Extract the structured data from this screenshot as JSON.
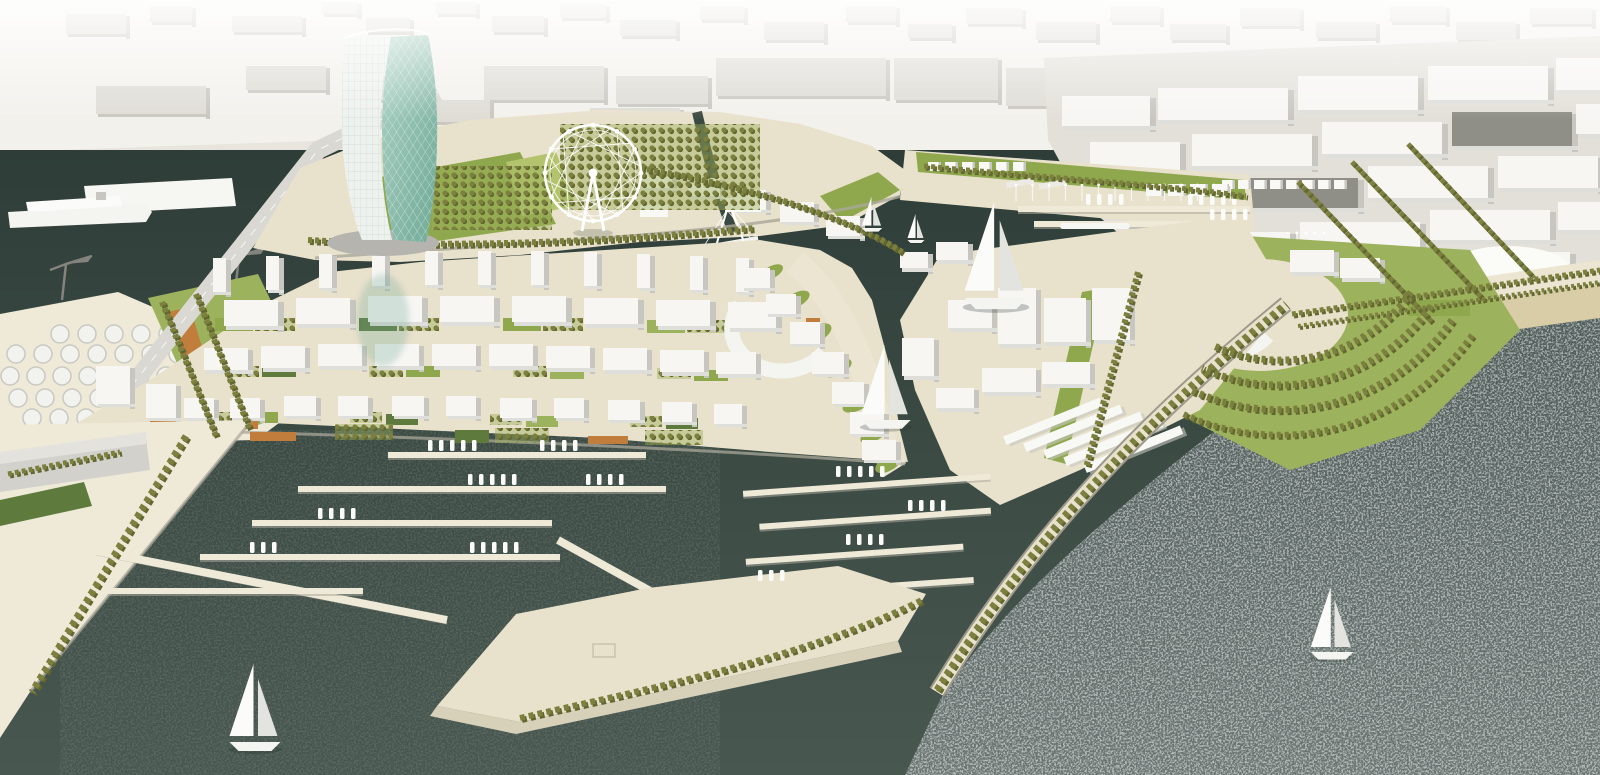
{
  "scene": {
    "description": "Aerial architectural rendering of a waterfront marina masterplan with twisted glass tower, ferris wheel, marinas, breakwaters, beach and background city massing",
    "objects": [
      "twisted-glass-tower",
      "ferris-wheel",
      "central-building-district",
      "left-marina",
      "middle-marina",
      "inner-basin",
      "east-breakwater",
      "beach",
      "open-sea",
      "port-tanks",
      "harbor-cranes",
      "cruise-ship",
      "road-bridge",
      "crescent-park",
      "sailboats"
    ]
  },
  "colors": {
    "bg": "#f3f1ec",
    "bg_block": "#dedcd5",
    "bg_block_side": "#c9c7c0",
    "coast": "#e7e5de",
    "pier_gray": "#dbd9d2",
    "water_top": "#2e3d38",
    "water_mid": "#3c4b44",
    "water_low": "#485750",
    "sea_top": "#4e5c59",
    "sea_low": "#6a7572",
    "land": "#e8e1cc",
    "paving": "#efe9d8",
    "sand": "#d9cda8",
    "prom": "#ece5d2",
    "city_ground": "#e2e0d8",
    "lawn": "#8fa84e",
    "lawn_light": "#b4c36e",
    "lawn_mid": "#9db25c",
    "green_dark": "#5e7a3d",
    "olive": "#7c803f",
    "olive_dark": "#62662f",
    "orange": "#c07d3b",
    "bldg_top": "#f7f6f3",
    "bldg_side": "#c7c6c0",
    "bldg_front": "#dededa",
    "bldg_dark": "#8f8f88",
    "road": "#d9d8d2",
    "quay_wall": "#a9a79a",
    "shadow": "#1f2a26",
    "glass1": "#aed3c6",
    "glass2": "#6fa996",
    "tower_white": "#eef2ee",
    "crane": "#84837d",
    "hull": "#f4f4f1",
    "sail": "#fbfbf9",
    "sail_shade": "#e3e3df",
    "tank": "#f2f2ef",
    "tank_edge": "#c9c8c2"
  },
  "blocks": {
    "bg-blocks": {
      "top": "bg_block",
      "side": "bg_block_side",
      "front": "bg_block_side",
      "sw": 4,
      "fh": 3,
      "items": [
        [
          66,
          14,
          60,
          20
        ],
        [
          150,
          6,
          42,
          16
        ],
        [
          232,
          16,
          70,
          16
        ],
        [
          322,
          2,
          36,
          12
        ],
        [
          366,
          18,
          44,
          14
        ],
        [
          436,
          2,
          40,
          12
        ],
        [
          492,
          16,
          52,
          16
        ],
        [
          560,
          4,
          46,
          14
        ],
        [
          620,
          20,
          56,
          16
        ],
        [
          700,
          6,
          44,
          14
        ],
        [
          764,
          22,
          60,
          18
        ],
        [
          846,
          6,
          50,
          16
        ],
        [
          908,
          24,
          44,
          14
        ],
        [
          966,
          8,
          56,
          16
        ],
        [
          1036,
          22,
          60,
          18
        ],
        [
          1110,
          6,
          50,
          16
        ],
        [
          1170,
          24,
          56,
          16
        ],
        [
          1240,
          8,
          60,
          18
        ],
        [
          1316,
          22,
          60,
          16
        ],
        [
          1390,
          6,
          56,
          16
        ],
        [
          1456,
          22,
          60,
          18
        ],
        [
          1530,
          8,
          62,
          16
        ],
        [
          484,
          66,
          120,
          34
        ],
        [
          616,
          76,
          92,
          28
        ],
        [
          716,
          58,
          170,
          38
        ],
        [
          894,
          58,
          104,
          42
        ],
        [
          1006,
          68,
          88,
          38
        ],
        [
          246,
          66,
          80,
          24
        ],
        [
          96,
          86,
          110,
          28
        ],
        [
          352,
          76,
          70,
          24
        ],
        [
          1106,
          60,
          80,
          30
        ],
        [
          590,
          108,
          90,
          26
        ],
        [
          430,
          100,
          60,
          22
        ]
      ]
    },
    "right-city-blocks": {
      "top": "bldg_top",
      "side": "bldg_side",
      "front": "bldg_front",
      "sw": 6,
      "fh": 4,
      "items": [
        [
          1062,
          96,
          88,
          30
        ],
        [
          1158,
          88,
          130,
          32
        ],
        [
          1298,
          76,
          120,
          34
        ],
        [
          1428,
          66,
          120,
          34
        ],
        [
          1556,
          58,
          44,
          32
        ],
        [
          1090,
          142,
          90,
          30
        ],
        [
          1192,
          134,
          120,
          32
        ],
        [
          1322,
          122,
          120,
          32
        ],
        [
          1452,
          112,
          120,
          34,
          "bldg_dark"
        ],
        [
          1576,
          104,
          24,
          30
        ],
        [
          1128,
          188,
          100,
          28
        ],
        [
          1238,
          178,
          120,
          30,
          "bldg_dark"
        ],
        [
          1368,
          166,
          120,
          32
        ],
        [
          1498,
          156,
          100,
          32
        ],
        [
          1180,
          232,
          110,
          26
        ],
        [
          1300,
          222,
          120,
          28
        ],
        [
          1430,
          210,
          120,
          30
        ],
        [
          1558,
          202,
          42,
          28
        ],
        [
          1250,
          272,
          100,
          24
        ],
        [
          1360,
          262,
          110,
          26,
          "bldg_dark"
        ],
        [
          1480,
          252,
          90,
          26
        ],
        [
          1310,
          300,
          130,
          22
        ],
        [
          1452,
          290,
          130,
          22
        ]
      ]
    },
    "district-fins": {
      "top": "bldg_top",
      "side": "bldg_side",
      "front": "bldg_front",
      "sw": 5,
      "fh": 3,
      "w": 13,
      "h": 34,
      "items": [
        [
          213,
          258
        ],
        [
          266,
          256
        ],
        [
          319,
          254
        ],
        [
          372,
          252
        ],
        [
          425,
          251
        ],
        [
          478,
          251
        ],
        [
          531,
          251
        ],
        [
          584,
          252
        ],
        [
          637,
          254
        ],
        [
          690,
          256
        ],
        [
          736,
          258
        ]
      ]
    },
    "district-row1": {
      "top": "bldg_top",
      "side": "bldg_side",
      "front": "bldg_front",
      "sw": 6,
      "fh": 4,
      "items": [
        [
          224,
          300,
          54,
          26
        ],
        [
          296,
          298,
          54,
          26
        ],
        [
          368,
          296,
          54,
          26
        ],
        [
          440,
          296,
          54,
          26
        ],
        [
          512,
          296,
          54,
          26
        ],
        [
          584,
          298,
          54,
          26
        ],
        [
          656,
          300,
          54,
          26
        ],
        [
          728,
          302,
          48,
          26
        ]
      ]
    },
    "district-row2": {
      "top": "bldg_top",
      "side": "bldg_side",
      "front": "bldg_front",
      "sw": 5,
      "fh": 4,
      "items": [
        [
          204,
          348,
          44,
          22
        ],
        [
          261,
          346,
          44,
          22
        ],
        [
          318,
          344,
          44,
          22
        ],
        [
          375,
          344,
          44,
          22
        ],
        [
          432,
          344,
          44,
          22
        ],
        [
          489,
          344,
          44,
          22
        ],
        [
          546,
          346,
          44,
          22
        ],
        [
          603,
          348,
          44,
          22
        ],
        [
          660,
          350,
          44,
          22
        ],
        [
          716,
          352,
          40,
          22
        ]
      ]
    },
    "district-row3": {
      "top": "bldg_top",
      "side": "bldg_side",
      "front": "bldg_front",
      "sw": 5,
      "fh": 3,
      "items": [
        [
          184,
          398,
          30,
          20
        ],
        [
          230,
          398,
          30,
          20
        ],
        [
          284,
          396,
          32,
          20
        ],
        [
          338,
          396,
          30,
          20
        ],
        [
          392,
          396,
          32,
          20
        ],
        [
          446,
          396,
          30,
          20
        ],
        [
          500,
          398,
          32,
          20
        ],
        [
          554,
          398,
          30,
          20
        ],
        [
          608,
          400,
          32,
          20
        ],
        [
          662,
          402,
          30,
          20
        ],
        [
          714,
          404,
          28,
          20
        ],
        [
          96,
          366,
          34,
          38
        ],
        [
          146,
          384,
          30,
          34
        ]
      ]
    },
    "boulevard-cubes": {
      "top": "bldg_top",
      "side": "bldg_side",
      "front": "bldg_front",
      "sw": 5,
      "fh": 3,
      "items": [
        [
          642,
          170,
          30,
          18
        ],
        [
          688,
          178,
          32,
          18
        ],
        [
          734,
          190,
          32,
          20
        ],
        [
          780,
          202,
          34,
          20
        ],
        [
          826,
          216,
          34,
          20
        ]
      ]
    },
    "curve-cubes": {
      "top": "bldg_top",
      "side": "bldg_side",
      "front": "bldg_front",
      "sw": 5,
      "fh": 3,
      "items": [
        [
          742,
          268,
          28,
          20
        ],
        [
          766,
          294,
          30,
          20
        ],
        [
          790,
          322,
          30,
          22
        ],
        [
          812,
          352,
          32,
          22
        ],
        [
          832,
          382,
          32,
          22
        ],
        [
          850,
          412,
          34,
          22
        ],
        [
          862,
          440,
          34,
          20
        ]
      ]
    },
    "right-district-blocks": {
      "top": "bldg_top",
      "side": "bldg_side",
      "front": "bldg_front",
      "sw": 5,
      "fh": 4,
      "items": [
        [
          948,
          300,
          44,
          28
        ],
        [
          998,
          288,
          38,
          56
        ],
        [
          1044,
          298,
          42,
          44
        ],
        [
          1092,
          288,
          38,
          52
        ],
        [
          982,
          368,
          54,
          24
        ],
        [
          1042,
          362,
          48,
          22
        ],
        [
          902,
          338,
          32,
          38
        ],
        [
          936,
          388,
          38,
          20
        ],
        [
          900,
          252,
          28,
          16
        ],
        [
          936,
          242,
          32,
          18
        ],
        [
          1290,
          250,
          44,
          22
        ],
        [
          1340,
          258,
          40,
          20
        ]
      ]
    }
  },
  "piers_left": [
    [
      388,
      452,
      258
    ],
    [
      298,
      486,
      368
    ],
    [
      252,
      520,
      300
    ],
    [
      200,
      554,
      360
    ],
    [
      108,
      588,
      255
    ]
  ],
  "piers_mid": [
    [
      746,
      480,
      248
    ],
    [
      760,
      514,
      232
    ],
    [
      744,
      548,
      218
    ],
    [
      732,
      582,
      238
    ]
  ],
  "piers_basin": [
    [
      1018,
      206,
      232
    ],
    [
      1034,
      221,
      204
    ]
  ],
  "jetties": [
    [
      558,
      540,
      652,
      592
    ],
    [
      96,
      551,
      447,
      620
    ]
  ],
  "boat_clusters": [
    [
      428,
      446,
      5
    ],
    [
      540,
      446,
      4
    ],
    [
      468,
      480,
      5
    ],
    [
      586,
      480,
      4
    ],
    [
      318,
      514,
      4
    ],
    [
      470,
      548,
      5
    ],
    [
      250,
      548,
      3
    ],
    [
      836,
      472,
      5
    ],
    [
      908,
      506,
      4
    ],
    [
      846,
      540,
      4
    ],
    [
      758,
      576,
      3
    ],
    [
      1086,
      200,
      4
    ],
    [
      1188,
      200,
      5
    ],
    [
      1210,
      215,
      4
    ]
  ],
  "tanks": [
    [
      60,
      334,
      6,
      27
    ],
    [
      16,
      354,
      7,
      27
    ],
    [
      10,
      376,
      8,
      26
    ],
    [
      18,
      398,
      7,
      27
    ],
    [
      32,
      418,
      6,
      27
    ]
  ],
  "masts": [
    [
      1016,
      186,
      14,
      16.5
    ],
    [
      1288,
      234,
      5,
      9
    ]
  ],
  "tents": [
    [
      928,
      162,
      6,
      17,
      13,
      9
    ],
    [
      1222,
      180,
      8,
      16,
      13,
      9
    ],
    [
      1146,
      184,
      4,
      22,
      18,
      12
    ]
  ],
  "sheds": [
    [
      1010,
      408
    ],
    [
      1026,
      422
    ],
    [
      1042,
      436
    ],
    [
      1058,
      450
    ],
    [
      1074,
      464
    ]
  ],
  "sailboats": [
    [
      255,
      742,
      1.5
    ],
    [
      886,
      420,
      1.45
    ],
    [
      996,
      298,
      1.85
    ],
    [
      1332,
      652,
      1.25
    ],
    [
      872,
      228,
      0.6
    ],
    [
      916,
      240,
      0.5
    ]
  ],
  "cranes": [
    [
      62,
      300
    ],
    [
      235,
      292
    ]
  ],
  "tree_lines": [
    [
      "M186,436 L32,692",
      7,
      "5 4"
    ],
    [
      "M162,302 L216,436",
      6,
      "4 3"
    ],
    [
      "M196,294 L250,430",
      6,
      "4 3"
    ],
    [
      "M308,240 C480,250 640,238 755,228",
      6,
      "4 3"
    ],
    [
      "M640,168 C770,190 856,222 902,252",
      6,
      "4 3"
    ],
    [
      "M924,166 C1050,178 1160,184 1246,196",
      5,
      "4 3"
    ],
    [
      "M937,690 C1020,556 1122,438 1286,304",
      7,
      "5 4"
    ],
    [
      "M1138,272 L1086,468",
      6,
      "4 3"
    ],
    [
      "M1298,182 L1432,322",
      5,
      "4 3"
    ],
    [
      "M1352,162 L1484,300",
      5,
      "4 3"
    ],
    [
      "M1408,144 L1534,278",
      5,
      "4 3"
    ],
    [
      "M1292,314 L1600,270",
      5,
      "4 3"
    ],
    [
      "M1298,326 L1600,282",
      4,
      "3 3"
    ],
    [
      "M1411,292 A160,160 0 0 1 1212,345",
      7,
      "4 4"
    ],
    [
      "M1431,306 A185,185 0 0 1 1202,368",
      7,
      "4 4"
    ],
    [
      "M1452,320 A210,210 0 0 1 1191,390",
      7,
      "4 4"
    ],
    [
      "M1472,335 A235,235 0 0 1 1181,413",
      6,
      "4 4"
    ],
    [
      "M520,718 C640,690 800,660 922,600",
      6,
      "5 4"
    ],
    [
      "M8,474 L120,452",
      5,
      "4 3"
    ]
  ],
  "lawn_rects": [
    [
      215,
      318,
      38,
      13,
      "lawn"
    ],
    [
      359,
      318,
      38,
      13,
      "green_dark"
    ],
    [
      503,
      318,
      38,
      13,
      "lawn"
    ],
    [
      647,
      320,
      38,
      13,
      "lawn_mid"
    ],
    [
      262,
      366,
      34,
      11,
      "green_dark"
    ],
    [
      406,
      366,
      34,
      11,
      "lawn"
    ],
    [
      550,
      368,
      34,
      11,
      "lawn_mid"
    ],
    [
      694,
      370,
      34,
      11,
      "lawn"
    ],
    [
      246,
      412,
      32,
      11,
      "lawn"
    ],
    [
      386,
      414,
      32,
      11,
      "green_dark"
    ],
    [
      526,
      416,
      32,
      11,
      "lawn_mid"
    ],
    [
      666,
      418,
      32,
      11,
      "green_dark"
    ],
    [
      455,
      430,
      34,
      13,
      "green_dark"
    ],
    [
      60,
      424,
      58,
      20,
      "lawn"
    ],
    [
      198,
      422,
      40,
      15,
      "lawn_mid"
    ],
    [
      1408,
      300,
      62,
      16,
      "lawn"
    ]
  ],
  "orchard_rects": [
    [
      255,
      318,
      40,
      13
    ],
    [
      399,
      318,
      40,
      13
    ],
    [
      543,
      318,
      40,
      13
    ],
    [
      687,
      320,
      40,
      13
    ],
    [
      225,
      366,
      34,
      11
    ],
    [
      369,
      366,
      34,
      11
    ],
    [
      513,
      366,
      34,
      11
    ],
    [
      657,
      368,
      34,
      11
    ],
    [
      210,
      412,
      32,
      11
    ],
    [
      350,
      412,
      32,
      11
    ],
    [
      490,
      414,
      32,
      11
    ],
    [
      630,
      416,
      32,
      11
    ],
    [
      335,
      424,
      58,
      16
    ],
    [
      495,
      428,
      54,
      15
    ],
    [
      645,
      430,
      58,
      15
    ],
    [
      432,
      166,
      120,
      64
    ],
    [
      560,
      124,
      200,
      86
    ]
  ],
  "orange_rects": [
    [
      150,
      414,
      28,
      12
    ],
    [
      228,
      416,
      30,
      13
    ],
    [
      250,
      432,
      46,
      9
    ],
    [
      588,
      436,
      40,
      8
    ],
    [
      806,
      318,
      14,
      5
    ],
    [
      838,
      388,
      14,
      5
    ]
  ],
  "green_blobs": [
    [
      796,
      300,
      15,
      7
    ],
    [
      816,
      334,
      17,
      8
    ],
    [
      838,
      368,
      15,
      7
    ],
    [
      858,
      402,
      17,
      8
    ],
    [
      874,
      434,
      15,
      7
    ],
    [
      888,
      464,
      14,
      7
    ],
    [
      772,
      272,
      12,
      6
    ]
  ],
  "ferris_wheel": {
    "cx": 593,
    "cy": 173,
    "r": 48,
    "spokes": 12,
    "gondolas": 12
  }
}
